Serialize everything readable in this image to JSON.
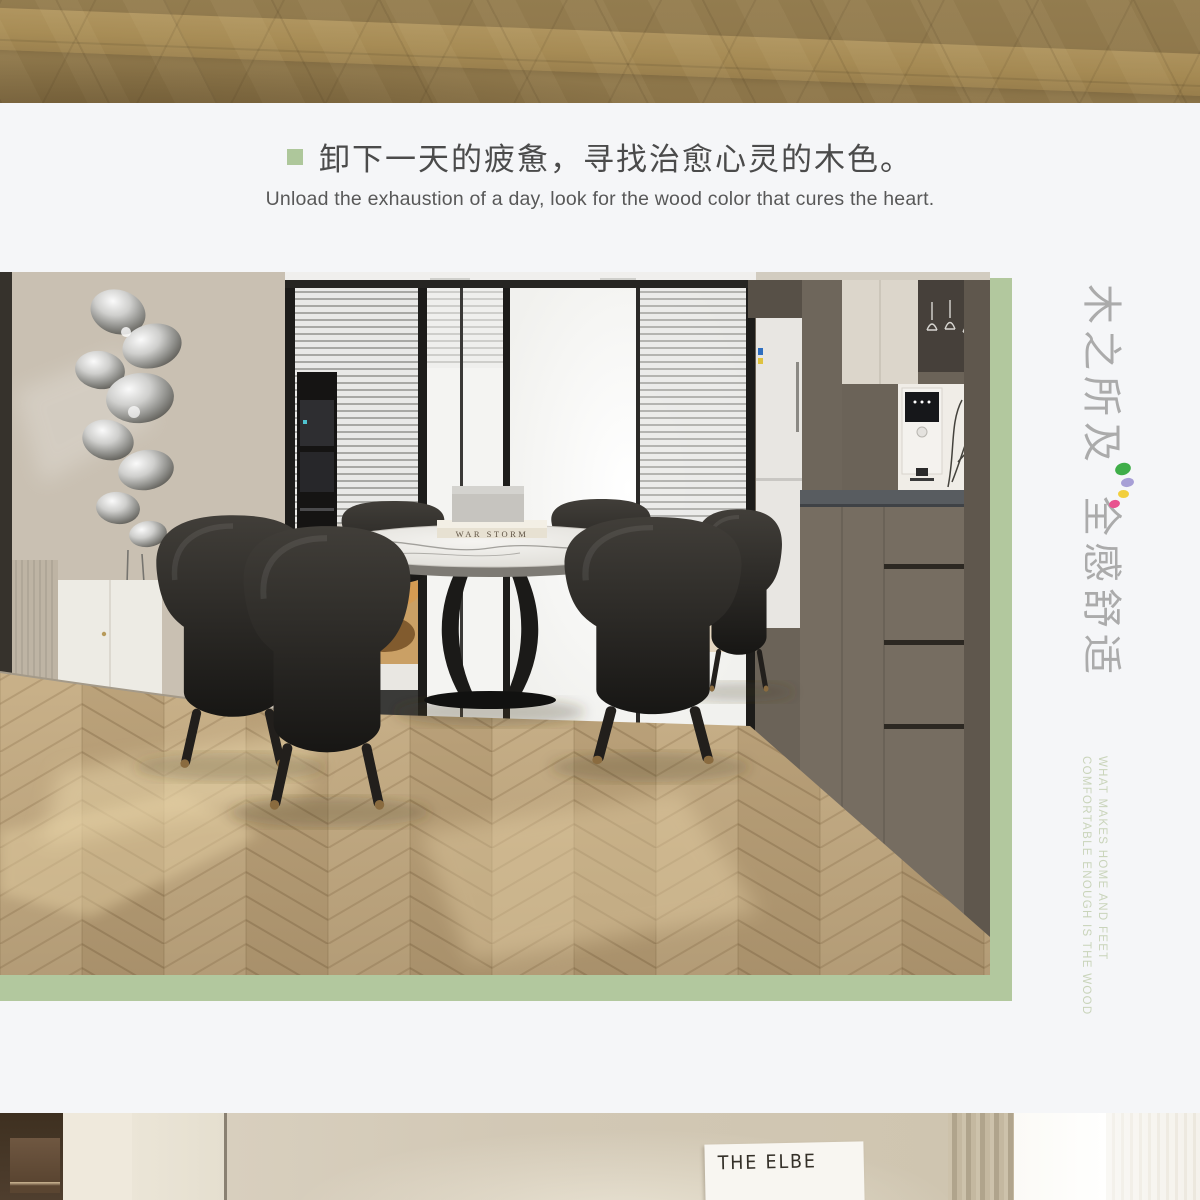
{
  "page": {
    "background": "#f5f6f8"
  },
  "top_banner": {
    "wood_base_color": "#8d7649",
    "wood_light_band_color": "#c5a45e"
  },
  "intro": {
    "bullet_color": "#aec79b",
    "headline_zh": "卸下一天的疲惫，寻找治愈心灵的木色。",
    "subtitle_en": "Unload the exhaustion of a day, look for the wood color that cures the heart."
  },
  "hero_photo": {
    "accent_panel_color": "#b2c89e",
    "book_title": "WAR STORM"
  },
  "brand_vertical": {
    "zh_line1": "木之所及",
    "zh_line2": "全感舒适",
    "zh_color": "#ababab",
    "dot_colors": [
      "#3fae49",
      "#a79fd6",
      "#f2cf3d",
      "#e8538f"
    ],
    "en_line1": "WHAT MAKES HOME AND FEET",
    "en_line2": "COMFORTABLE ENOUGH IS THE WOOD",
    "en_color": "#c9d4ba"
  },
  "bottom_photo": {
    "poster_text": "THE ELBE"
  }
}
